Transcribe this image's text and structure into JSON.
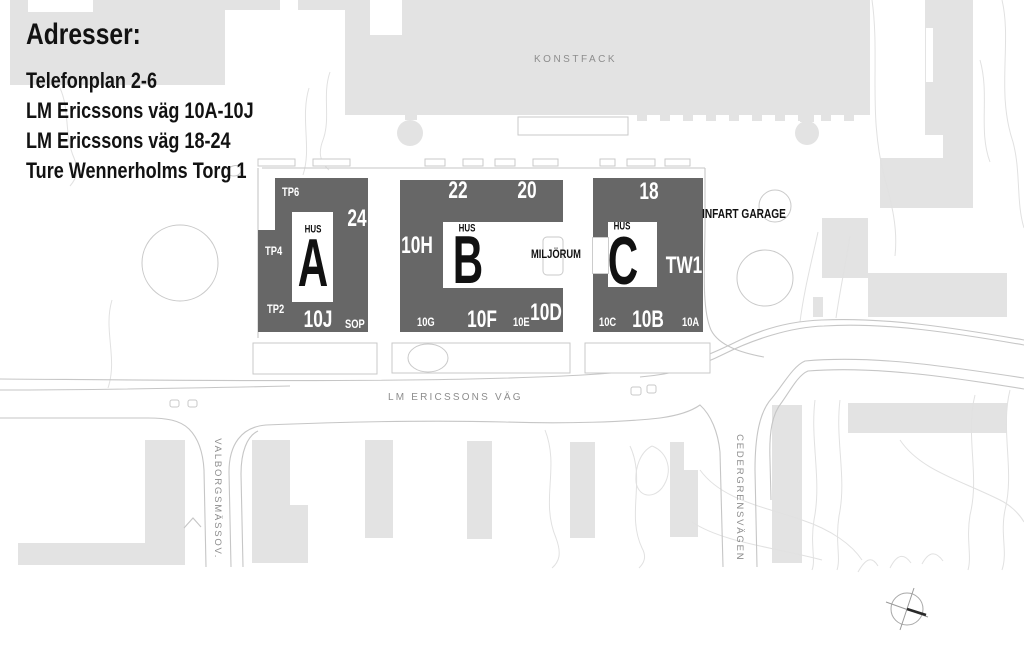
{
  "addresses": {
    "heading": "Adresser:",
    "lines": [
      "Telefonplan 2-6",
      "LM Ericssons väg 10A-10J",
      "LM Ericssons väg 18-24",
      "Ture Wennerholms Torg 1"
    ]
  },
  "areas": {
    "konstfack": "KONSTFACK",
    "infart_garage": "INFART GARAGE",
    "miljorum": "MILJÖRUM"
  },
  "streets": {
    "main": "LM ERICSSONS VÄG",
    "left": "VALBORGSMÄSSOV.",
    "right": "CEDERGRENSVÄGEN"
  },
  "buildings": {
    "a": {
      "hus": "HUS",
      "letter": "A",
      "tp6": "TP6",
      "tp4": "TP4",
      "tp2": "TP2",
      "n24": "24",
      "n10j": "10J",
      "sop": "SOP"
    },
    "b": {
      "hus": "HUS",
      "letter": "B",
      "n22": "22",
      "n20": "20",
      "n10h": "10H",
      "n10g": "10G",
      "n10f": "10F",
      "n10e": "10E",
      "n10d": "10D"
    },
    "c": {
      "hus": "HUS",
      "letter": "C",
      "n18": "18",
      "tw1": "TW1",
      "n10c": "10C",
      "n10b": "10B",
      "n10a": "10A"
    }
  },
  "colors": {
    "building_dark": "#676767",
    "building_light": "#e3e3e3",
    "outline_line": "#c6c6c6",
    "contour_line": "#e1e1e1",
    "map_text_gray": "#8d8d8d",
    "text_black": "#111111"
  }
}
